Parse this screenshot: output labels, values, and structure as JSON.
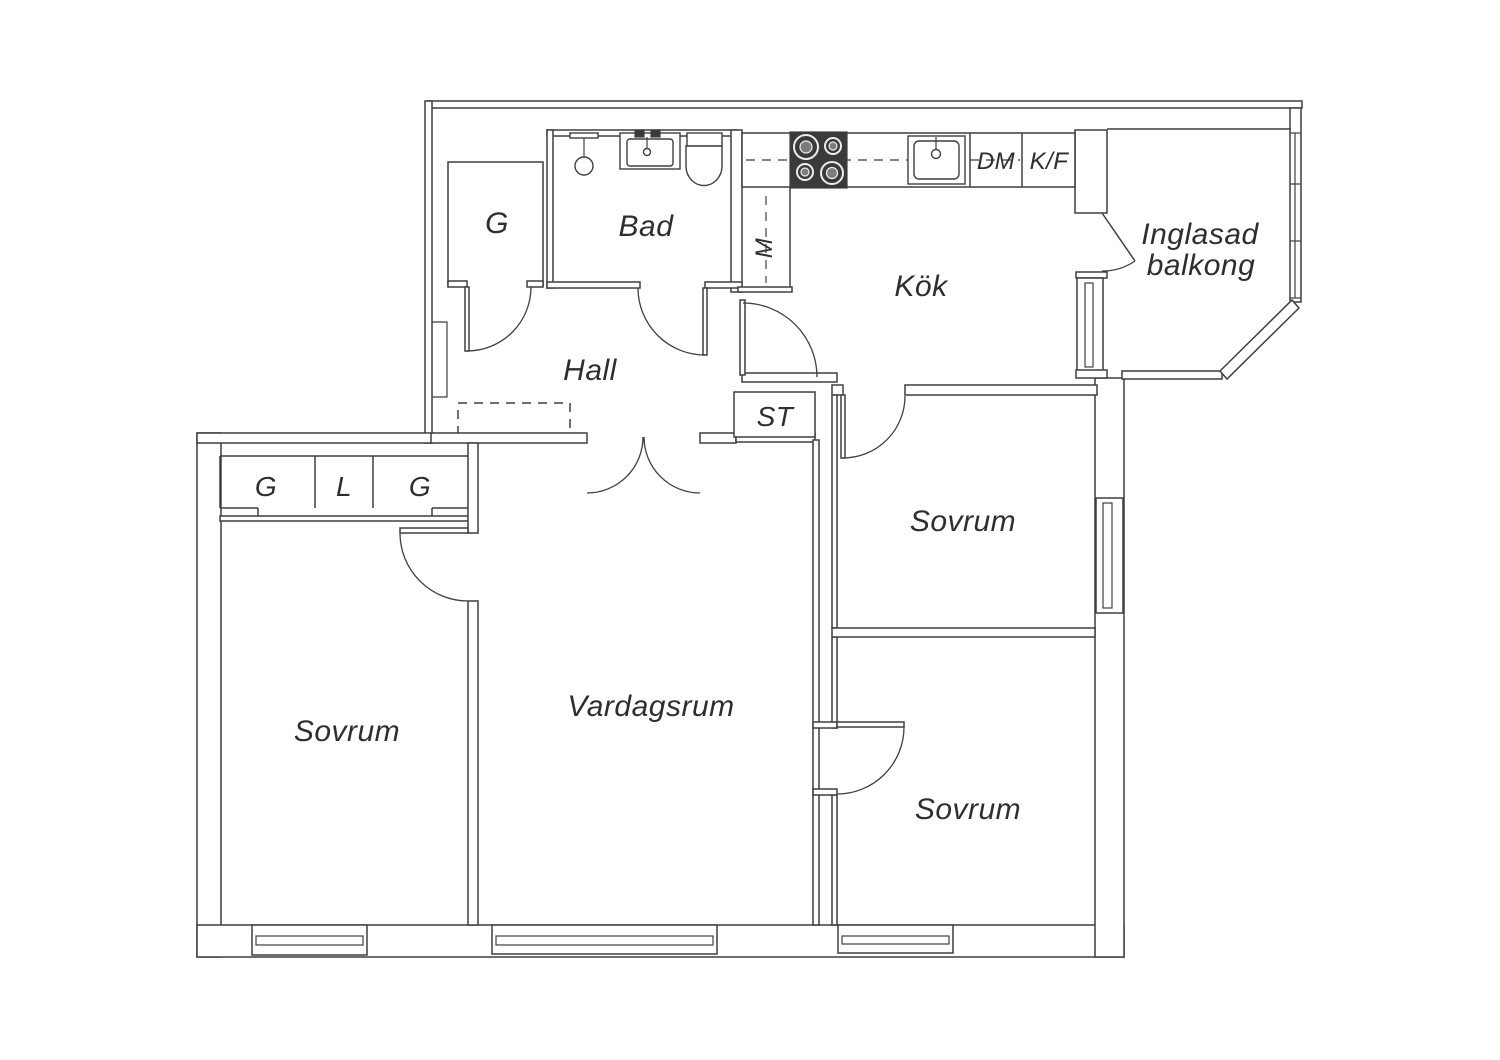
{
  "floorplan": {
    "kind": "apartment-floor-plan",
    "colors": {
      "line": "#3f3f3f",
      "text": "#2e2e2e",
      "background": "#ffffff",
      "stove": "#3a3a3a"
    },
    "labels": {
      "hall": "Hall",
      "bad": "Bad",
      "kok": "Kök",
      "vardagsrum": "Vardagsrum",
      "sovrum_left": "Sovrum",
      "sovrum_top_right": "Sovrum",
      "sovrum_bottom_right": "Sovrum",
      "balcony_line1": "Inglasad",
      "balcony_line2": "balkong",
      "closet_hall": "G",
      "closet_g1": "G",
      "closet_l": "L",
      "closet_g2": "G",
      "st_closet": "ST",
      "m_unit": "M",
      "dm_unit": "DM",
      "kf_unit": "K/F"
    }
  }
}
